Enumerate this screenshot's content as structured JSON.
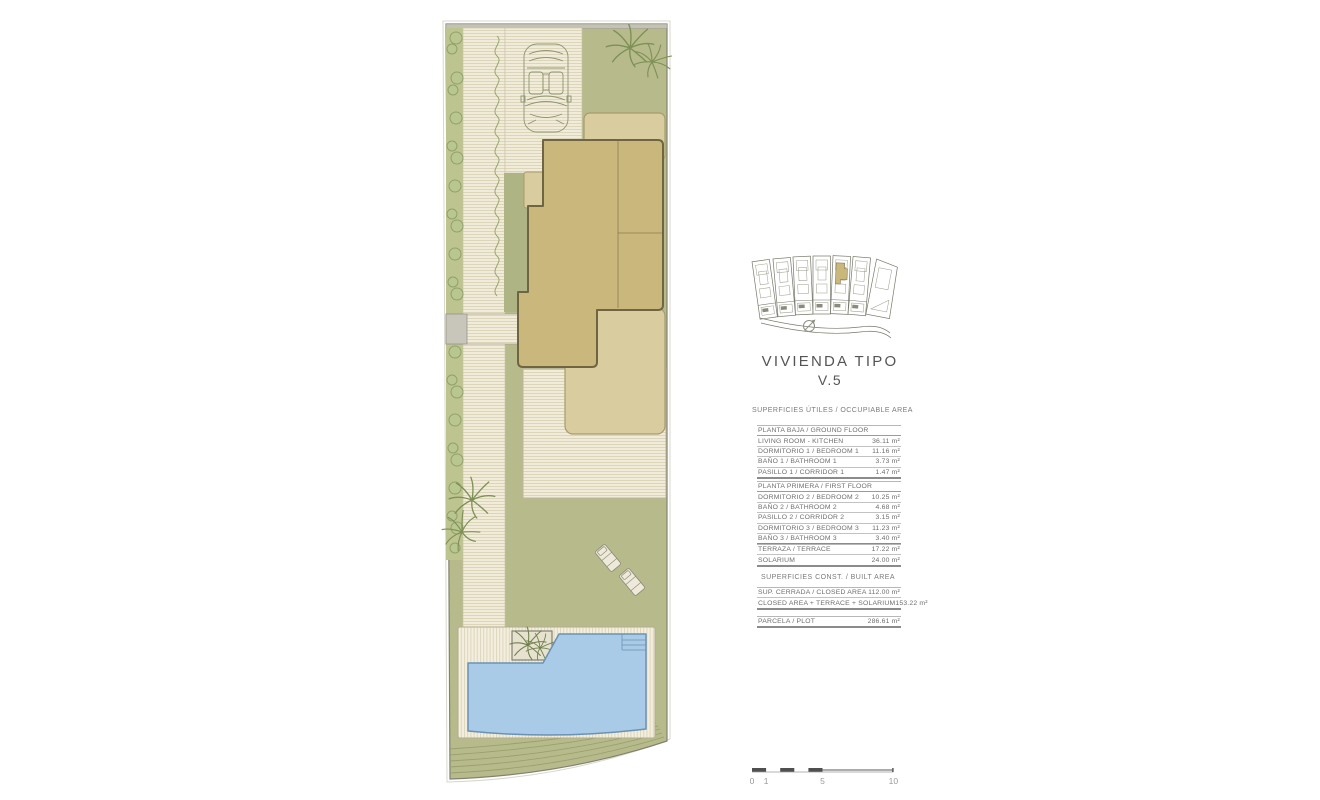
{
  "title": {
    "line1": "VIVIENDA TIPO",
    "line2": "V.5"
  },
  "headings": {
    "occupiable": "SUPERFICIES ÚTILES / OCCUPIABLE AREA",
    "built": "SUPERFICIES CONST. / BUILT AREA"
  },
  "tables": {
    "ground_floor": {
      "header": "PLANTA BAJA / GROUND FLOOR",
      "rows": [
        {
          "label": "LIVING ROOM - KITCHEN",
          "value": "36.11 m²"
        },
        {
          "label": "DORMITORIO 1 /  BEDROOM 1",
          "value": "11.16 m²"
        },
        {
          "label": "BAÑO 1 / BATHROOM 1",
          "value": "3.73 m²"
        },
        {
          "label": "PASILLO 1 / CORRIDOR 1",
          "value": "1.47 m²"
        }
      ]
    },
    "first_floor": {
      "header": "PLANTA PRIMERA / FIRST FLOOR",
      "rows": [
        {
          "label": "DORMITORIO 2 / BEDROOM 2",
          "value": "10.25 m²"
        },
        {
          "label": "BAÑO 2 / BATHROOM 2",
          "value": "4.68 m²"
        },
        {
          "label": "PASILLO 2 / CORRIDOR 2",
          "value": "3.15 m²"
        },
        {
          "label": "DORMITORIO 3 / BEDROOM 3",
          "value": "11.23 m²"
        },
        {
          "label": "BAÑO 3 / BATHROOM 3",
          "value": "3.40 m²"
        }
      ]
    },
    "terrace": {
      "rows": [
        {
          "label": "TERRAZA / TERRACE",
          "value": "17.22 m²"
        },
        {
          "label": "SOLARIUM",
          "value": "24.00 m²"
        }
      ]
    },
    "built": {
      "rows": [
        {
          "label": "SUP. CERRADA / CLOSED AREA",
          "value": "112.00 m²"
        },
        {
          "label": "CLOSED AREA + TERRACE + SOLARIUM",
          "value": "153.22 m²"
        }
      ]
    },
    "plot": {
      "rows": [
        {
          "label": "PARCELA / PLOT",
          "value": "286.61 m²"
        }
      ]
    }
  },
  "scalebar": {
    "labels": [
      "0",
      "1",
      "5",
      "10"
    ]
  },
  "keyplan": {
    "units_total": 7,
    "highlighted_unit": 5
  },
  "site_plan_features": [
    "plot-boundary",
    "driveway",
    "car",
    "hedge",
    "garden-path",
    "house-footprint",
    "porch",
    "terrace",
    "wood-deck",
    "palm-trees",
    "sun-loungers",
    "planter",
    "swimming-pool",
    "pool-steps",
    "terraced-slope"
  ],
  "palette": {
    "paper": "#ffffff",
    "ink": "#555555",
    "table_ink": "#6e6e6e",
    "rule": "#c2c2c2",
    "rule_heavy": "#8b8b8b",
    "lawn": "#b7bb8c",
    "stripe_bg": "#f1ecd9",
    "stripe_line": "#dcd5b9",
    "house": "#c9b77c",
    "house_outline": "#6f6543",
    "terrace": "#d9cd9f",
    "pool": "#a9cbe7",
    "pool_outline": "#6a92b5",
    "highlight": "#c9b77c",
    "plant": "#8fa065",
    "scale_ink": "#4f4f4f"
  }
}
